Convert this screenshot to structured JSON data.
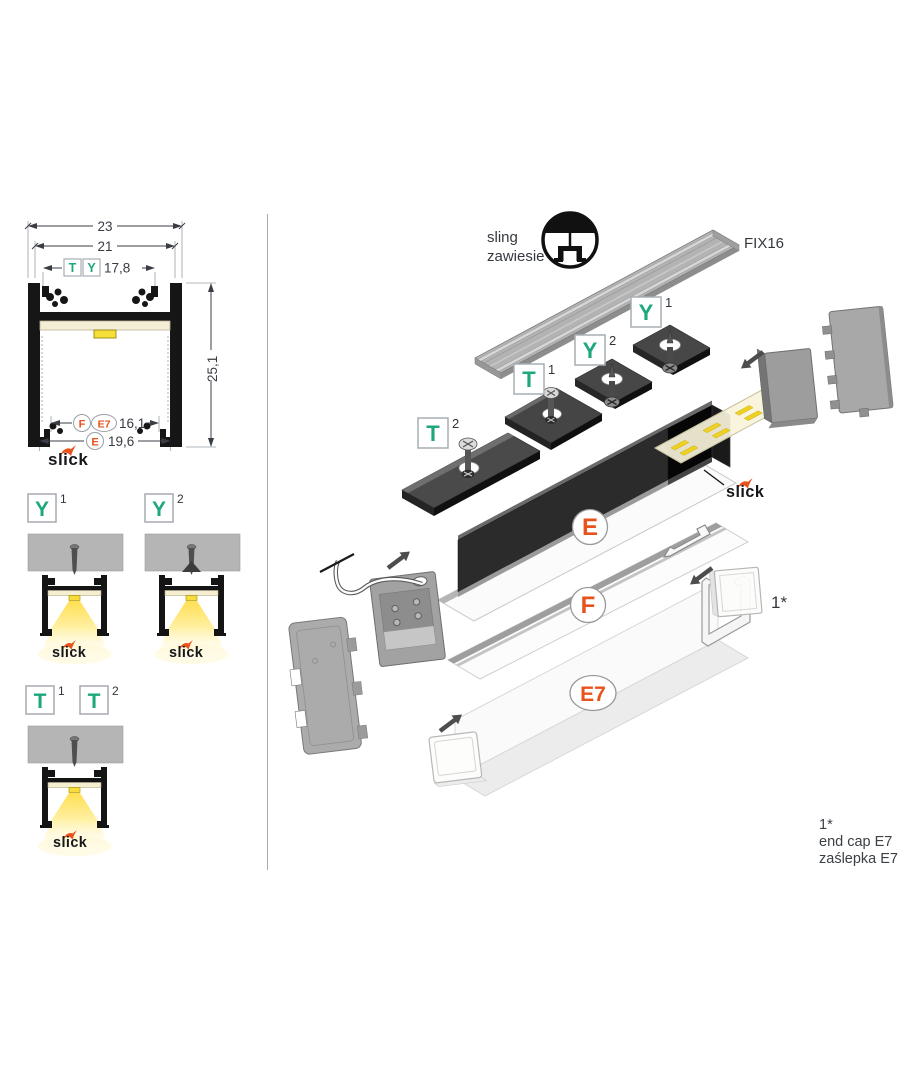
{
  "colors": {
    "teal": "#1CA77D",
    "orange": "#E8521C",
    "ink": "#383c42"
  },
  "cross_section": {
    "dim_outer_width": "23",
    "dim_inner_width": "21",
    "dim_ty_width": "17,8",
    "dim_height": "25,1",
    "dim_fe7_width": "16,1",
    "dim_e_width": "19,6",
    "tag_t": "T",
    "tag_y": "Y",
    "tag_f": "F",
    "tag_e7": "E7",
    "tag_e": "E",
    "logo": "slick"
  },
  "variants": {
    "y1_letter": "Y",
    "y1_sup": "1",
    "y2_letter": "Y",
    "y2_sup": "2",
    "t1_letter": "T",
    "t1_sup": "1",
    "t2_letter": "T",
    "t2_sup": "2"
  },
  "exploded": {
    "sling_line1": "sling",
    "sling_line2": "zawiesie",
    "rail_label": "FIX16",
    "y1_letter": "Y",
    "y1_sup": "1",
    "y2_letter": "Y",
    "y2_sup": "2",
    "t1_letter": "T",
    "t1_sup": "1",
    "t2_letter": "T",
    "t2_sup": "2",
    "label_e": "E",
    "label_f": "F",
    "label_e7": "E7",
    "endcap_marker": "1*"
  },
  "footnote": {
    "marker": "1*",
    "line1": "end cap E7",
    "line2": "zaślepka E7"
  }
}
